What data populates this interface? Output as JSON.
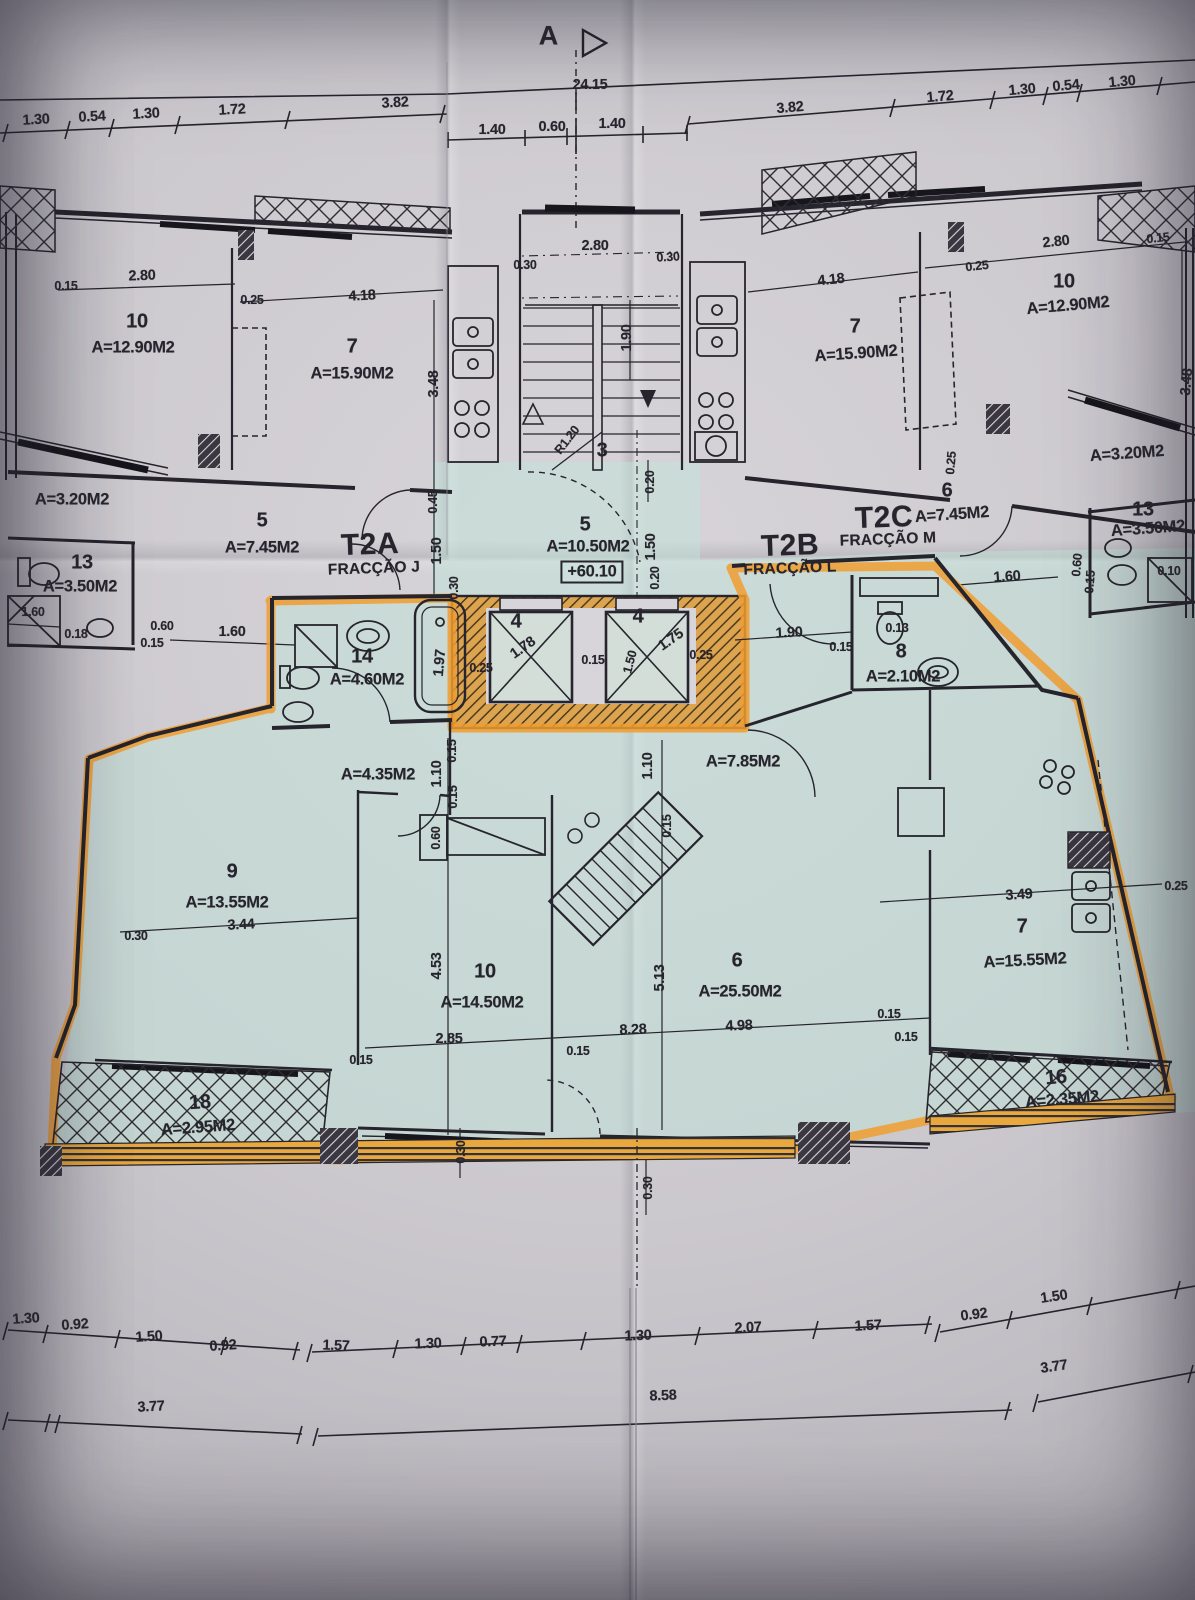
{
  "section_marker": {
    "label": "A"
  },
  "elevation": "+60.10",
  "fractions": {
    "t2a": {
      "code": "T2A",
      "name": "FRACÇÃO J"
    },
    "t2b": {
      "code": "T2B",
      "name": "FRACÇÃO L"
    },
    "t2c": {
      "code": "T2C",
      "name": "FRACÇÃO M"
    }
  },
  "rooms": {
    "l10": {
      "num": "10",
      "area": "A=12.90M2"
    },
    "l7": {
      "num": "7",
      "area": "A=15.90M2"
    },
    "l_terrace": {
      "area": "A=3.20M2"
    },
    "l13": {
      "num": "13",
      "area": "A=3.50M2"
    },
    "l5": {
      "num": "5",
      "area": "A=7.45M2"
    },
    "c5": {
      "num": "5",
      "area": "A=10.50M2"
    },
    "c3": {
      "num": "3"
    },
    "lift_a": {
      "num": "4"
    },
    "lift_b": {
      "num": "4"
    },
    "r7": {
      "num": "7",
      "area": "A=15.90M2"
    },
    "r10": {
      "num": "10",
      "area": "A=12.90M2"
    },
    "r_terrace": {
      "area": "A=3.20M2"
    },
    "r13": {
      "num": "13",
      "area": "A=3.50M2"
    },
    "r6": {
      "num": "6",
      "area": "A=7.45M2"
    },
    "u14": {
      "num": "14",
      "area": "A=4.60M2"
    },
    "u8": {
      "num": "8",
      "area": "A=2.10M2"
    },
    "u_hall_a": {
      "area": "A=4.35M2"
    },
    "u_hall_b": {
      "area": "A=7.85M2"
    },
    "u9": {
      "num": "9",
      "area": "A=13.55M2"
    },
    "u10": {
      "num": "10",
      "area": "A=14.50M2"
    },
    "u6": {
      "num": "6",
      "area": "A=25.50M2"
    },
    "u7": {
      "num": "7",
      "area": "A=15.55M2"
    },
    "u18": {
      "num": "18",
      "area": "A=2.95M2"
    },
    "u16": {
      "num": "16",
      "area": "A=2.35M2"
    }
  },
  "dims": {
    "top_total": "24.15",
    "top_left": [
      "1.30",
      "0.54",
      "1.30",
      "1.72",
      "3.82"
    ],
    "top_center": [
      "1.40",
      "0.60",
      "1.40"
    ],
    "top_right": [
      "3.82",
      "1.72",
      "1.30",
      "0.54",
      "1.30"
    ],
    "apt_left": [
      "0.15",
      "2.80",
      "0.25",
      "4.18",
      "3.48",
      "1.60",
      "0.60",
      "0.15",
      "0.18",
      "1.60",
      "0.45",
      "1.50",
      "0.30"
    ],
    "core": [
      "2.80",
      "0.30",
      "0.30",
      "1.90",
      "R1.20",
      "0.20",
      "1.97",
      "0.25",
      "1.78",
      "0.15",
      "1.50",
      "1.75",
      "0.25",
      "1.50",
      "0.20"
    ],
    "apt_right": [
      "4.18",
      "0.25",
      "2.80",
      "0.15",
      "1.60",
      "0.60",
      "0.15",
      "0.10",
      "0.25",
      "3.48"
    ],
    "unit": [
      "1.90",
      "0.15",
      "0.13",
      "0.15",
      "1.10",
      "0.15",
      "0.60",
      "1.10",
      "0.15",
      "3.44",
      "0.30",
      "4.53",
      "2.85",
      "0.15",
      "8.28",
      "4.98",
      "5.13",
      "0.15",
      "3.49",
      "0.25",
      "0.15",
      "0.30",
      "0.30",
      "0.15"
    ],
    "bottom_a": [
      "1.30",
      "0.92",
      "1.50",
      "0.92",
      "1.57",
      "1.30",
      "0.77",
      "1.30",
      "2.07",
      "1.57",
      "0.92",
      "1.50"
    ],
    "bottom_b": [
      "3.77",
      "8.58",
      "3.77"
    ]
  },
  "colors": {
    "highlighter": "#f09d30",
    "tint": "#bfe3d8",
    "ink": "#26242c",
    "paper": "#cbc8ce"
  }
}
